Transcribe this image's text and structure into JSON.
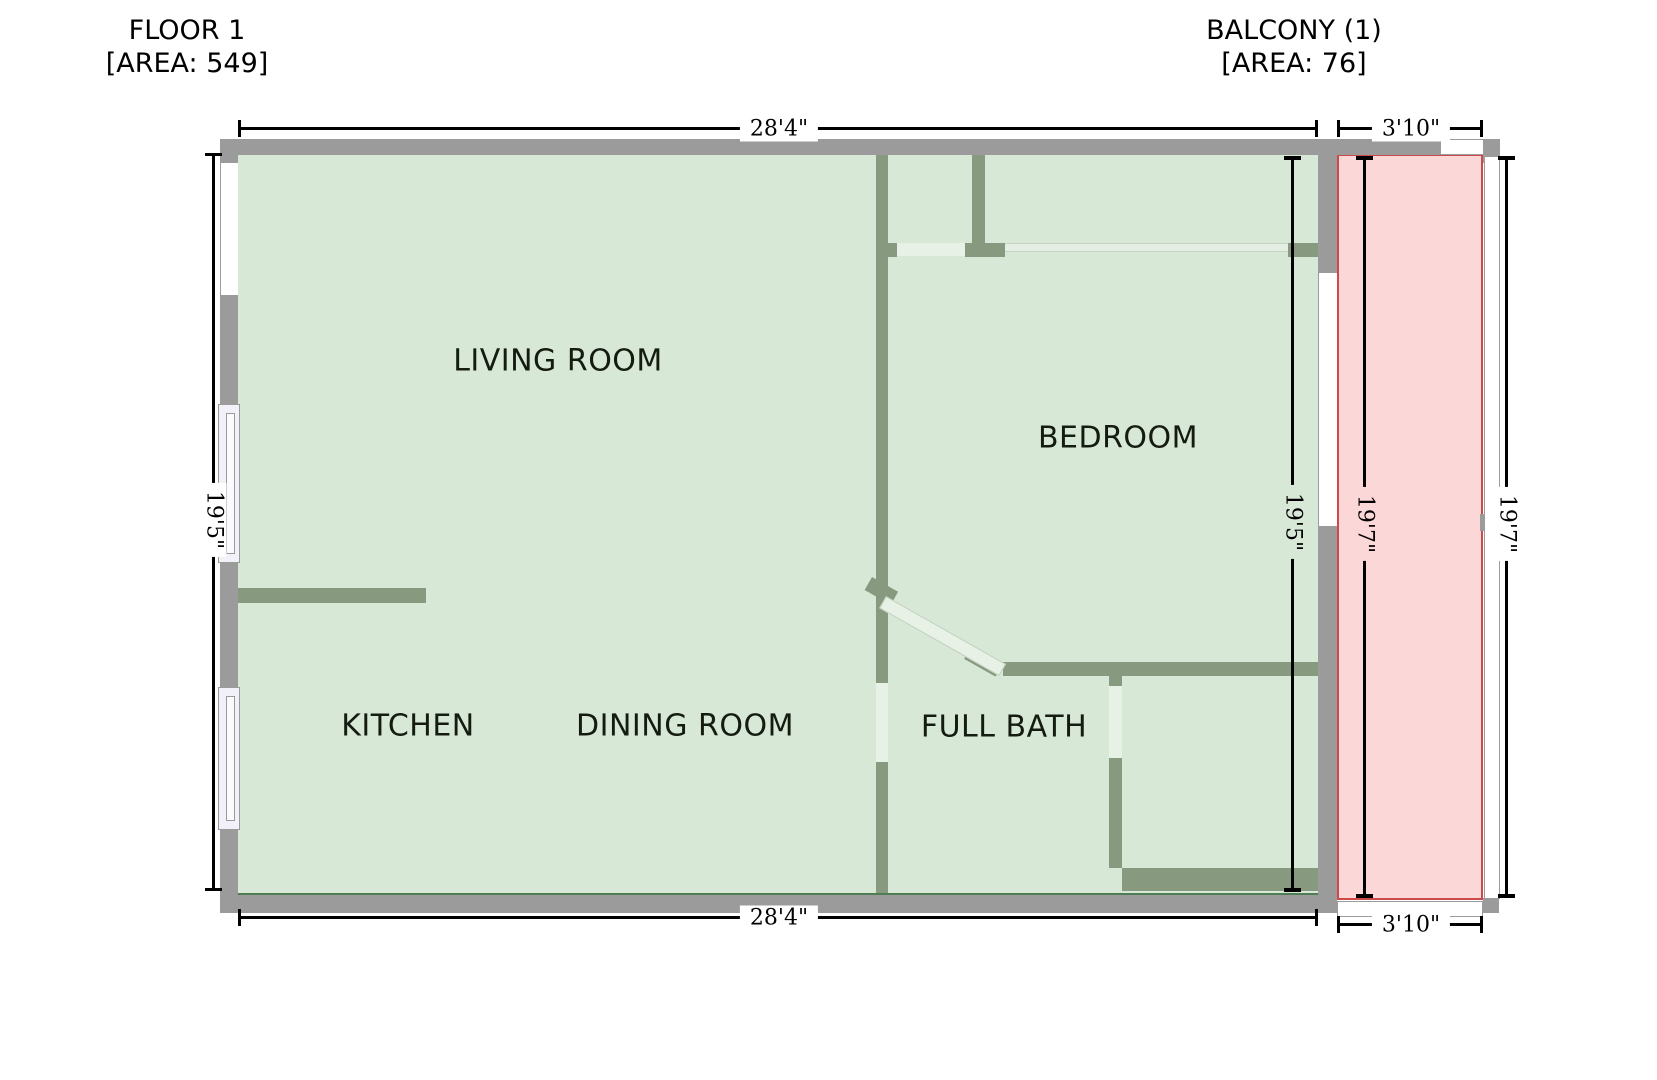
{
  "titles": {
    "floor": {
      "name": "FLOOR 1",
      "area": "[AREA: 549]"
    },
    "balcony": {
      "name": "BALCONY (1)",
      "area": "[AREA: 76]"
    }
  },
  "rooms": {
    "living_room": "LIVING ROOM",
    "bedroom": "BEDROOM",
    "kitchen": "KITCHEN",
    "dining_room": "DINING ROOM",
    "full_bath": "FULL BATH"
  },
  "dimensions": {
    "floor_width_top": "28'4\"",
    "floor_width_bottom": "28'4\"",
    "floor_height_left": "19'5\"",
    "bedroom_height": "19'5\"",
    "balcony_width_top": "3'10\"",
    "balcony_width_bottom": "3'10\"",
    "balcony_height_inner": "19'7\"",
    "balcony_height_outer": "19'7\""
  },
  "colors": {
    "floor_fill": "#d8e8d6",
    "floor_border": "#4f7d53",
    "balcony_fill": "#fcd7d7",
    "balcony_border": "#cd4a4a",
    "wall_outer": "#9b9b9b",
    "wall_inner": "#879a80",
    "dim_line": "#000000"
  }
}
